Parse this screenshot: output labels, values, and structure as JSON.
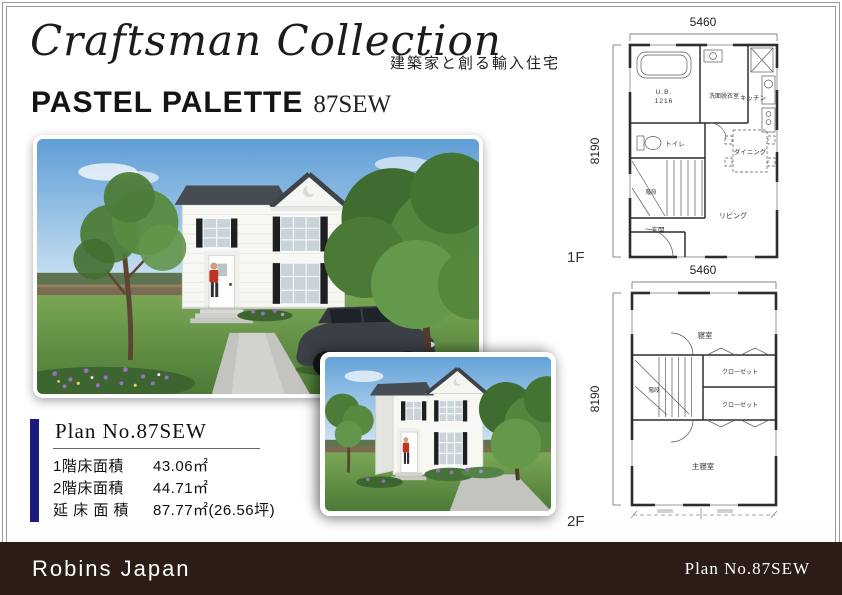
{
  "header": {
    "brand": "Craftsman Collection",
    "tagline": "建築家と創る輸入住宅",
    "series": "PASTEL PALETTE",
    "model": "87SEW"
  },
  "plan_info": {
    "title": "Plan No.87SEW",
    "rows": [
      {
        "label": "1階床面積",
        "value": "43.06㎡"
      },
      {
        "label": "2階床面積",
        "value": "44.71㎡"
      },
      {
        "label": "延 床 面 積",
        "value": "87.77㎡(26.56坪)"
      }
    ]
  },
  "floorplan_1f": {
    "floor_label": "1F",
    "dim_top": "5460",
    "dim_left": "8190",
    "dim_bottom": "5460",
    "rooms": {
      "bath_line1": "U.B.",
      "bath_line2": "1216",
      "washroom": "洗面脱衣室",
      "kitchen": "キッチン",
      "toilet": "トイレ",
      "stairs": "階段",
      "dining": "ダイニング",
      "living": "リビング",
      "entrance": "玄関"
    }
  },
  "floorplan_2f": {
    "floor_label": "2F",
    "dim_left": "8190",
    "rooms": {
      "bedroom": "寝室",
      "closet1": "クローゼット",
      "closet2": "クローゼット",
      "stairs": "階段",
      "master_bedroom": "主寝室"
    }
  },
  "footer": {
    "company": "Robins Japan",
    "plan_no": "Plan No.87SEW"
  },
  "colors": {
    "accent_navy": "#1b1b7e",
    "footer_brown": "#2b1d16",
    "frame_line": "#9a9a9a"
  }
}
